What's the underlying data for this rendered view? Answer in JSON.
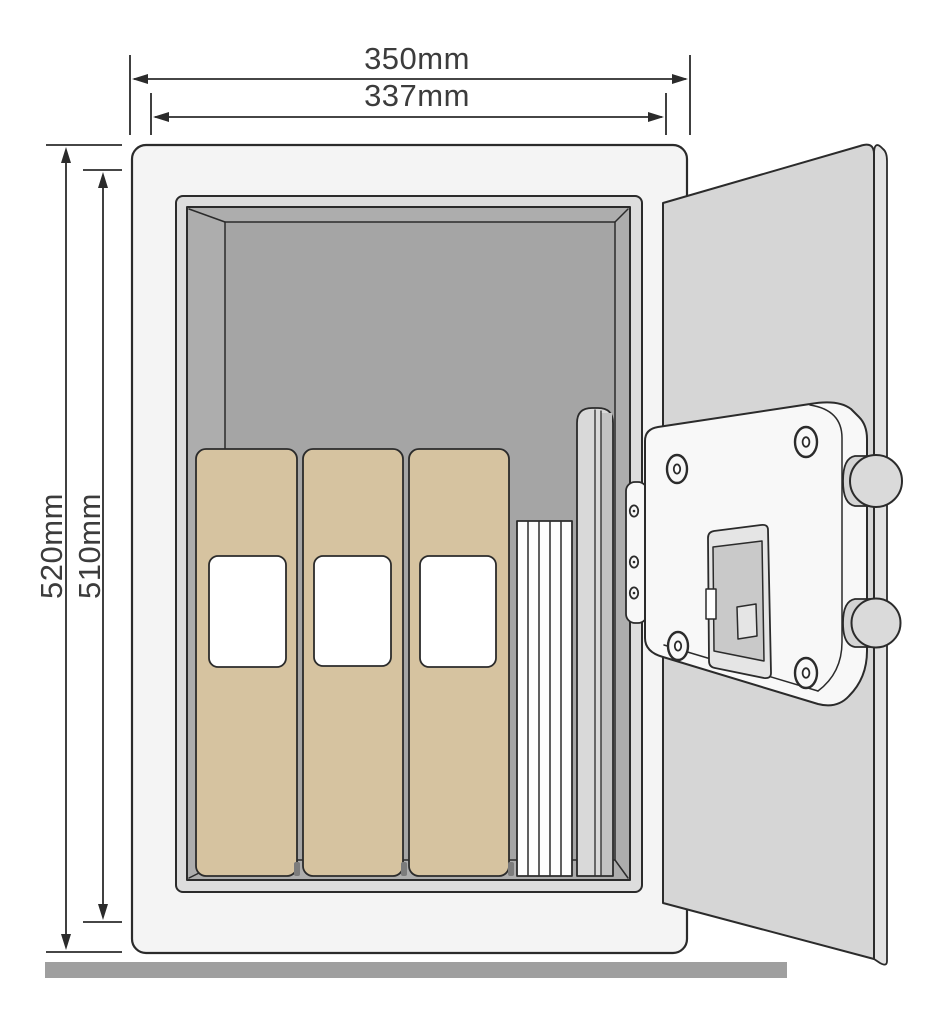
{
  "diagram": {
    "dimensions": {
      "outer_width": "350mm",
      "inner_width": "337mm",
      "outer_height": "520mm",
      "inner_height": "510mm"
    },
    "colors": {
      "outline": "#2b2b2b",
      "dim_text": "#3c3c3c",
      "body": "#f4f4f4",
      "frame": "#dddddd",
      "interior_wall": "#adadad",
      "interior_back": "#a5a5a5",
      "door": "#d6d6d6",
      "door_edge": "#e2e2e2",
      "panel": "#f8f8f8",
      "binder": "#d6c3a0",
      "binder_label": "#ffffff",
      "paper": "#fdfdfd",
      "folder": "#d9d9d9",
      "folder_shade": "#c3c3c3",
      "keypad_frame": "#e5e5e5",
      "keypad_display": "#c9c9c9",
      "knob": "#d4d4d4",
      "knob_face": "#dadada",
      "floor": "#9f9f9f"
    }
  }
}
